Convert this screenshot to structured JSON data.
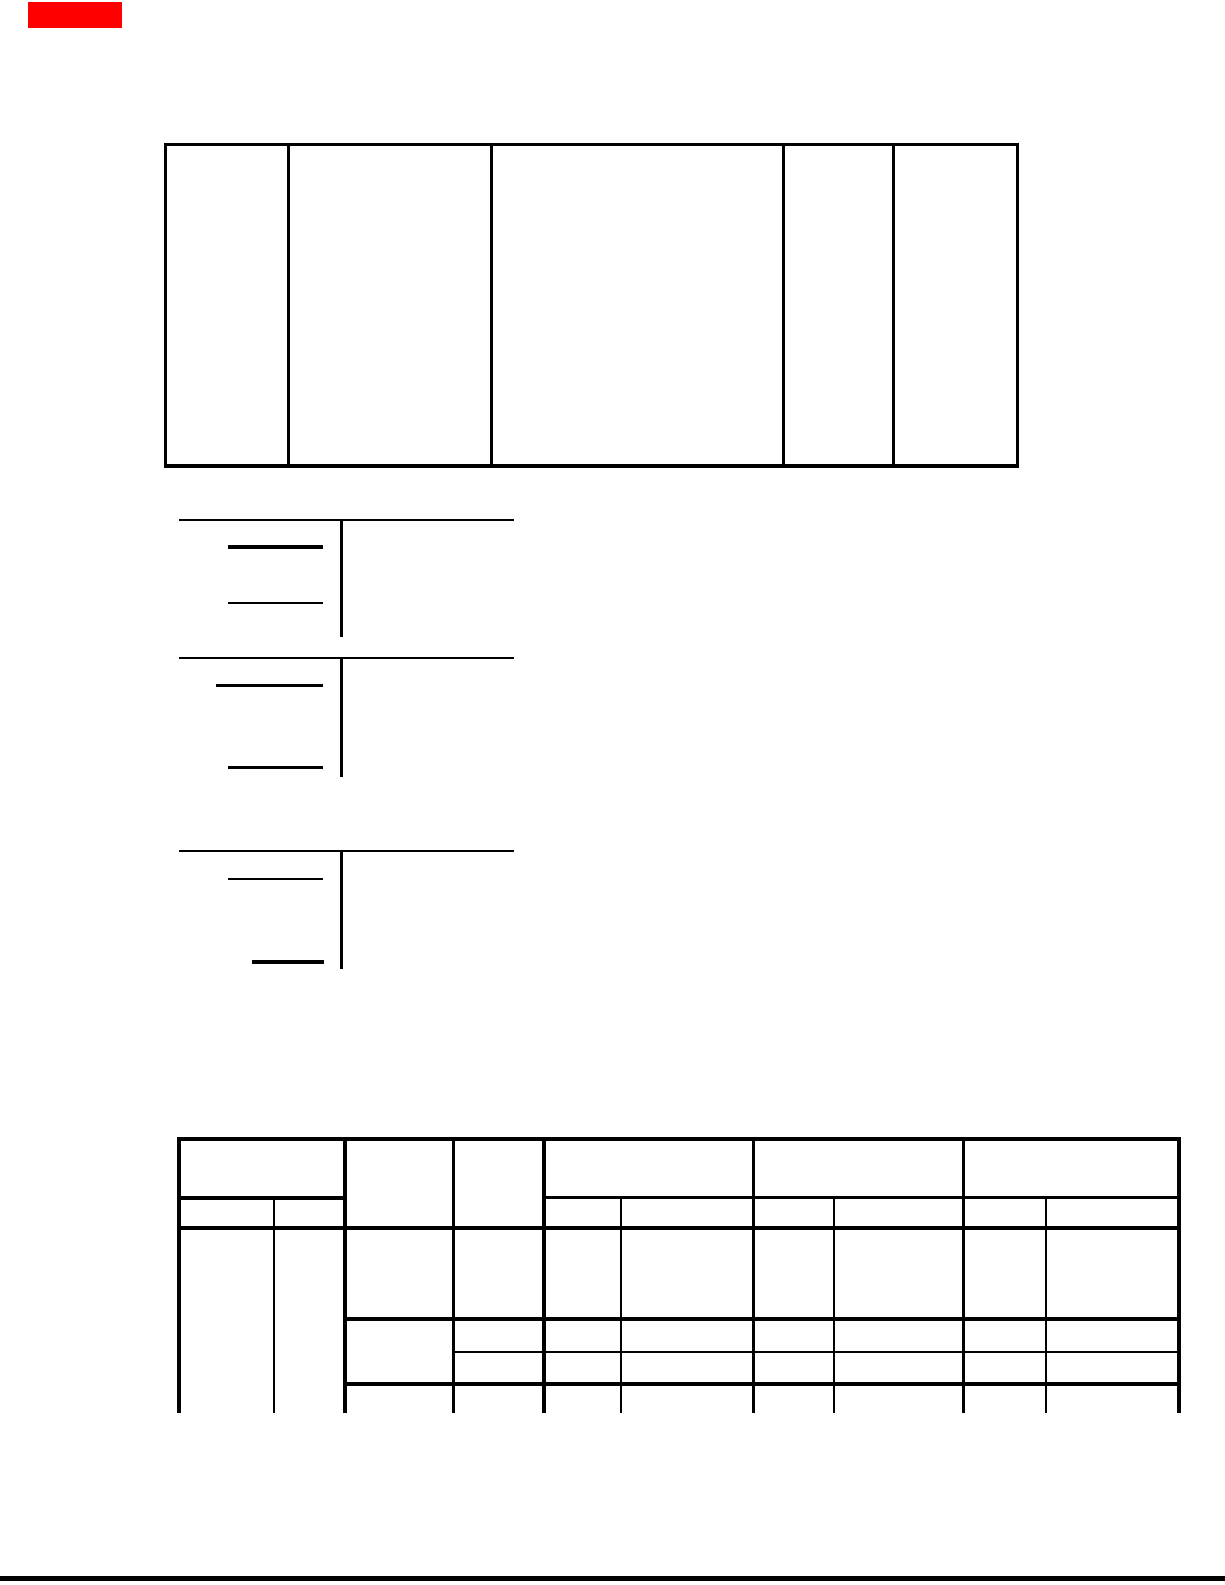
{
  "page": {
    "width": 1225,
    "height": 1585,
    "background_color": "#ffffff",
    "ink_color": "#000000",
    "marker_color": "#ff0000"
  },
  "marks": {
    "rects": [
      {
        "name": "red-marker-block",
        "x": 28,
        "y": 2,
        "w": 94,
        "h": 26,
        "color": "#ff0000"
      }
    ],
    "hlines": [
      {
        "name": "top-table-top-border",
        "x1": 164,
        "x2": 1019,
        "y": 143,
        "t": 3
      },
      {
        "name": "top-table-bottom-border",
        "x1": 164,
        "x2": 1019,
        "y": 464,
        "t": 4
      },
      {
        "name": "formula1-top-rule",
        "x1": 179,
        "x2": 514,
        "y": 519,
        "t": 2
      },
      {
        "name": "formula1-numerator-bar",
        "x1": 228,
        "x2": 323,
        "y": 545,
        "t": 4
      },
      {
        "name": "formula1-denominator-bar",
        "x1": 228,
        "x2": 323,
        "y": 602,
        "t": 1.5
      },
      {
        "name": "formula2-top-rule",
        "x1": 179,
        "x2": 514,
        "y": 657,
        "t": 2
      },
      {
        "name": "formula2-numerator-bar",
        "x1": 216,
        "x2": 323,
        "y": 684,
        "t": 3
      },
      {
        "name": "formula2-denominator-bar",
        "x1": 228,
        "x2": 323,
        "y": 766,
        "t": 3
      },
      {
        "name": "formula3-top-rule",
        "x1": 179,
        "x2": 514,
        "y": 850,
        "t": 2
      },
      {
        "name": "formula3-numerator-bar",
        "x1": 228,
        "x2": 323,
        "y": 878,
        "t": 1.5
      },
      {
        "name": "formula3-denominator-bar",
        "x1": 252,
        "x2": 324,
        "y": 960,
        "t": 4
      },
      {
        "name": "bottom-table-top-border",
        "x1": 177,
        "x2": 1181,
        "y": 1137,
        "t": 4
      },
      {
        "name": "bottom-table-subheader-rule-left",
        "x1": 177,
        "x2": 345,
        "y": 1196,
        "t": 4
      },
      {
        "name": "bottom-table-subheader-rule-right",
        "x1": 542,
        "x2": 1181,
        "y": 1196,
        "t": 3
      },
      {
        "name": "bottom-table-header-bottom-rule",
        "x1": 177,
        "x2": 1181,
        "y": 1226,
        "t": 4
      },
      {
        "name": "bottom-table-body-row1-rule",
        "x1": 343,
        "x2": 1181,
        "y": 1317,
        "t": 4
      },
      {
        "name": "bottom-table-body-row2-rule-thin",
        "x1": 452,
        "x2": 1181,
        "y": 1351,
        "t": 2
      },
      {
        "name": "bottom-table-body-row3-rule",
        "x1": 343,
        "x2": 1181,
        "y": 1382,
        "t": 4
      },
      {
        "name": "page-footer-rule",
        "x1": 0,
        "x2": 1225,
        "y": 1576,
        "t": 5
      }
    ],
    "vlines": [
      {
        "name": "top-table-left-border",
        "x": 164,
        "y1": 143,
        "y2": 468,
        "t": 3
      },
      {
        "name": "top-table-col1-divider",
        "x": 287,
        "y1": 143,
        "y2": 468,
        "t": 3
      },
      {
        "name": "top-table-col2-divider",
        "x": 490,
        "y1": 143,
        "y2": 468,
        "t": 3
      },
      {
        "name": "top-table-col3-divider",
        "x": 782,
        "y1": 143,
        "y2": 468,
        "t": 3
      },
      {
        "name": "top-table-col4-divider",
        "x": 892,
        "y1": 143,
        "y2": 468,
        "t": 3
      },
      {
        "name": "top-table-right-border",
        "x": 1016,
        "y1": 143,
        "y2": 468,
        "t": 3
      },
      {
        "name": "formula1-column-divider",
        "x": 340,
        "y1": 521,
        "y2": 637,
        "t": 3
      },
      {
        "name": "formula2-column-divider",
        "x": 340,
        "y1": 659,
        "y2": 777,
        "t": 3
      },
      {
        "name": "formula3-column-divider",
        "x": 340,
        "y1": 852,
        "y2": 969,
        "t": 3
      },
      {
        "name": "bottom-table-left-border",
        "x": 177,
        "y1": 1137,
        "y2": 1413,
        "t": 4
      },
      {
        "name": "bottom-table-col1-sub-divider",
        "x": 273,
        "y1": 1196,
        "y2": 1413,
        "t": 2
      },
      {
        "name": "bottom-table-col1-right-divider",
        "x": 343,
        "y1": 1137,
        "y2": 1413,
        "t": 4
      },
      {
        "name": "bottom-table-col2-right-divider",
        "x": 452,
        "y1": 1137,
        "y2": 1413,
        "t": 3
      },
      {
        "name": "bottom-table-col3-right-divider",
        "x": 542,
        "y1": 1137,
        "y2": 1413,
        "t": 4
      },
      {
        "name": "bottom-table-col4-sub-divider",
        "x": 620,
        "y1": 1196,
        "y2": 1413,
        "t": 2
      },
      {
        "name": "bottom-table-col4-right-divider",
        "x": 752,
        "y1": 1137,
        "y2": 1413,
        "t": 3
      },
      {
        "name": "bottom-table-col5-sub-divider",
        "x": 833,
        "y1": 1196,
        "y2": 1413,
        "t": 2
      },
      {
        "name": "bottom-table-col5-right-divider",
        "x": 962,
        "y1": 1137,
        "y2": 1413,
        "t": 3
      },
      {
        "name": "bottom-table-col6-sub-divider",
        "x": 1045,
        "y1": 1196,
        "y2": 1413,
        "t": 2
      },
      {
        "name": "bottom-table-right-border",
        "x": 1177,
        "y1": 1137,
        "y2": 1413,
        "t": 4
      }
    ]
  }
}
